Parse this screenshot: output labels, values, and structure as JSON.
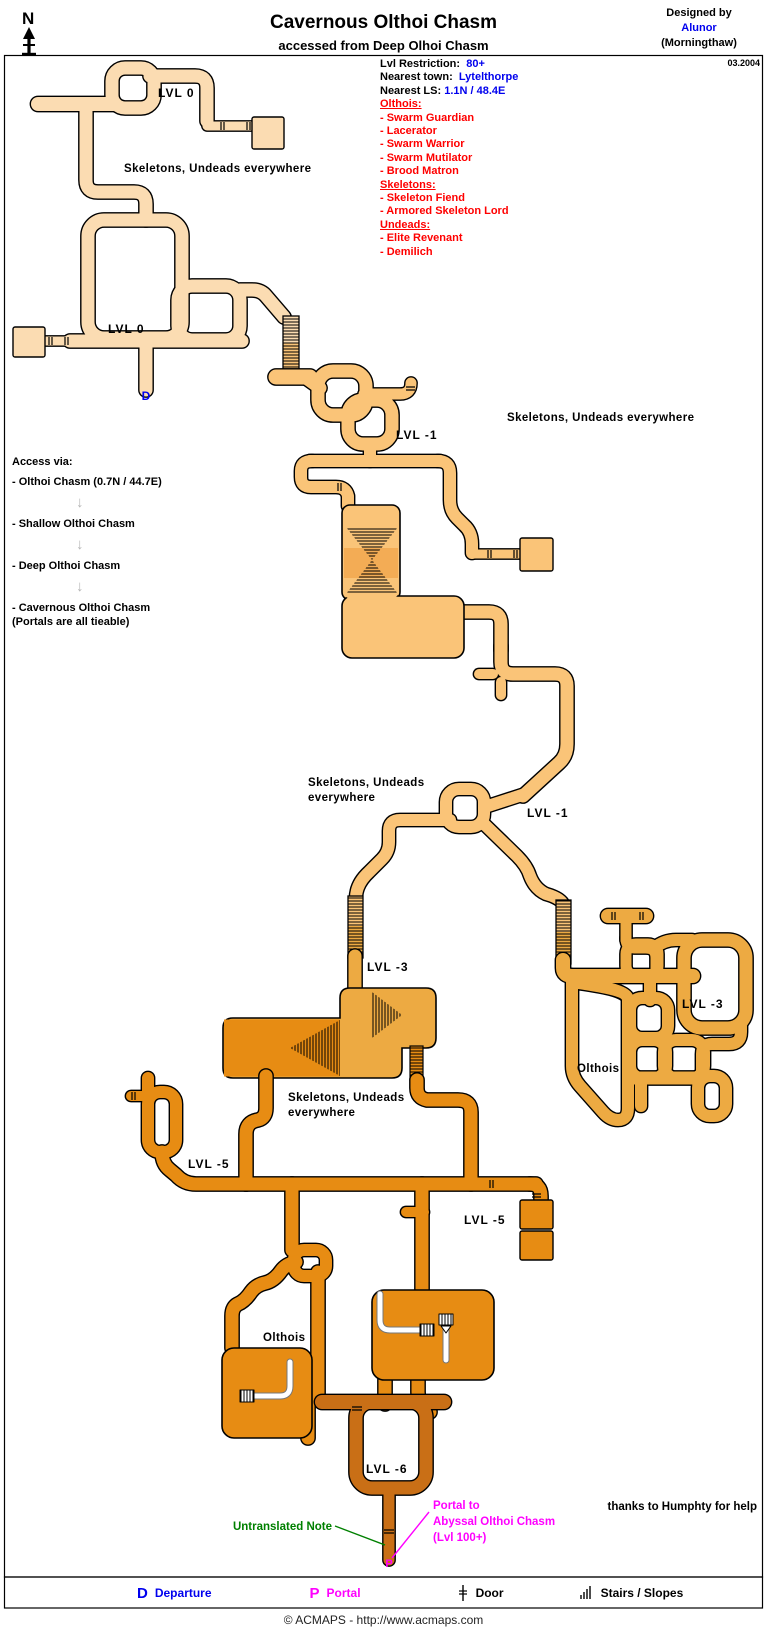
{
  "header": {
    "compass": "N",
    "title": "Cavernous Olthoi Chasm",
    "subtitle": "accessed from Deep Olhoi Chasm",
    "designed_by": "Designed by",
    "designer": "Alunor",
    "server": "(Morningthaw)",
    "date": "03.2004"
  },
  "info": {
    "lvl_restriction_label": "Lvl Restriction:",
    "lvl_restriction": "80+",
    "nearest_town_label": "Nearest town:",
    "nearest_town": "Lytelthorpe",
    "nearest_ls_label": "Nearest LS:",
    "nearest_ls": "1.1N / 48.4E",
    "groups": [
      {
        "heading": "Olthois:",
        "items": [
          "- Swarm Guardian",
          "- Lacerator",
          "- Swarm Warrior",
          "- Swarm Mutilator",
          "- Brood Matron"
        ]
      },
      {
        "heading": "Skeletons:",
        "items": [
          "- Skeleton Fiend",
          "- Armored Skeleton Lord"
        ]
      },
      {
        "heading": "Undeads:",
        "items": [
          "- Elite Revenant",
          "- Demilich"
        ]
      }
    ]
  },
  "access": {
    "heading": "Access via:",
    "steps": [
      "- Olthoi Chasm  (0.7N / 44.7E)",
      "- Shallow Olthoi Chasm",
      "- Deep Olthoi Chasm",
      "- Cavernous Olthoi Chasm"
    ],
    "note": "(Portals are all tieable)"
  },
  "map_labels": {
    "lvl0_a": "LVL 0",
    "lvl0_b": "LVL 0",
    "lvl1_a": "LVL -1",
    "lvl1_b": "LVL -1",
    "lvl3_a": "LVL -3",
    "lvl3_b": "LVL -3",
    "lvl5_a": "LVL -5",
    "lvl5_b": "LVL -5",
    "lvl6": "LVL -6",
    "skeletons_a": "Skeletons, Undeads  everywhere",
    "skeletons_b": "Skeletons, Undeads everywhere",
    "skeletons_c1": "Skeletons, Undeads",
    "skeletons_c2": "everywhere",
    "skeletons_d1": "Skeletons, Undeads",
    "skeletons_d2": "everywhere",
    "olthois_a": "Olthois",
    "olthois_b": "Olthois",
    "departure_marker": "D",
    "portal_marker": "P",
    "untranslated_note": "Untranslated Note",
    "portal_note_1": "Portal to",
    "portal_note_2": "Abyssal Olthoi Chasm",
    "portal_note_3": "(Lvl 100+)",
    "thanks": "thanks to Humphty for help"
  },
  "legend": {
    "departure_key": "D",
    "departure": "Departure",
    "portal_key": "P",
    "portal": "Portal",
    "door": "Door",
    "stairs": "Stairs / Slopes"
  },
  "footer": {
    "text": "© ACMAPS - http://www.acmaps.com"
  },
  "colors": {
    "lvl0": "#FBDCB2",
    "lvl1": "#FAC478",
    "lvl3": "#EDAA42",
    "lvl5": "#E78C13",
    "lvl6": "#C96F16",
    "accent_blue": "#0000EE",
    "accent_red": "#FF0000",
    "accent_magenta": "#FF00FF",
    "accent_green": "#008000"
  }
}
